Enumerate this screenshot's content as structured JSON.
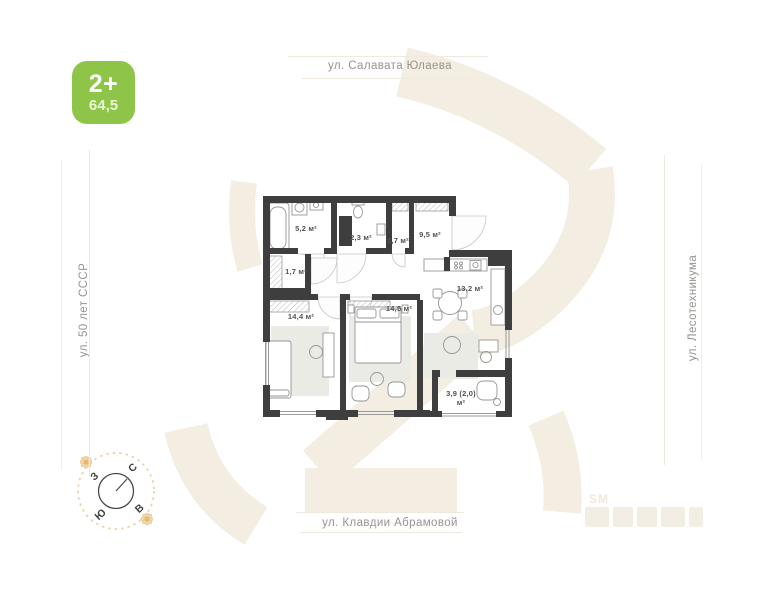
{
  "badge": {
    "rooms_label": "2+",
    "total_area": "64,5",
    "color": "#8ec549"
  },
  "streets": {
    "top": "ул. Салавата Юлаева",
    "left": "ул. 50 лет СССР",
    "right": "ул. Лесотехникума",
    "bottom": "ул. Клавдии Абрамовой"
  },
  "compass": {
    "north": "С",
    "south": "Ю",
    "west": "З",
    "east": "В"
  },
  "watermark": {
    "small_text": "SM"
  },
  "plan": {
    "rooms": [
      {
        "name": "bathroom",
        "area_label": "5,2 м²"
      },
      {
        "name": "toilet",
        "area_label": "2,3 м²"
      },
      {
        "name": "closet-top",
        "area_label": "1,7 м²"
      },
      {
        "name": "hallway",
        "area_label": "9,5 м²"
      },
      {
        "name": "closet-left",
        "area_label": "1,7 м²"
      },
      {
        "name": "bedroom-left",
        "area_label": "14,4 м²"
      },
      {
        "name": "bedroom-middle",
        "area_label": "14,5 м²"
      },
      {
        "name": "kitchen-living",
        "area_label": "13,2 м²"
      },
      {
        "name": "balcony",
        "area_label": "3,9 (2,0)",
        "area_label_line2": "м²"
      }
    ]
  }
}
